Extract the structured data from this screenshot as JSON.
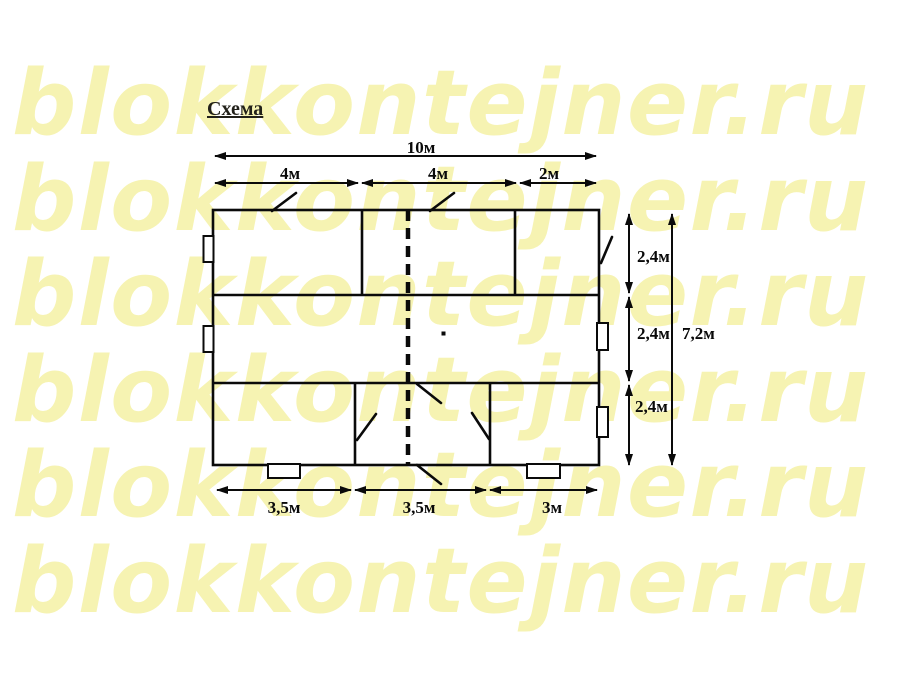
{
  "watermark": {
    "text": "blokkontejner.ru",
    "color": "#f6f3b2",
    "rows": 6
  },
  "title": {
    "text": "Схема"
  },
  "diagram": {
    "type": "floor_plan_schema",
    "line_color": "#0a0a0a",
    "dimensions": {
      "top_total": "10м",
      "top_segments": [
        "4м",
        "4м",
        "2м"
      ],
      "right_segments": [
        "2,4м",
        "2,4м",
        "2,4м"
      ],
      "right_total": "7,2м",
      "bottom_segments": [
        "3,5м",
        "3,5м",
        "3м"
      ]
    }
  }
}
